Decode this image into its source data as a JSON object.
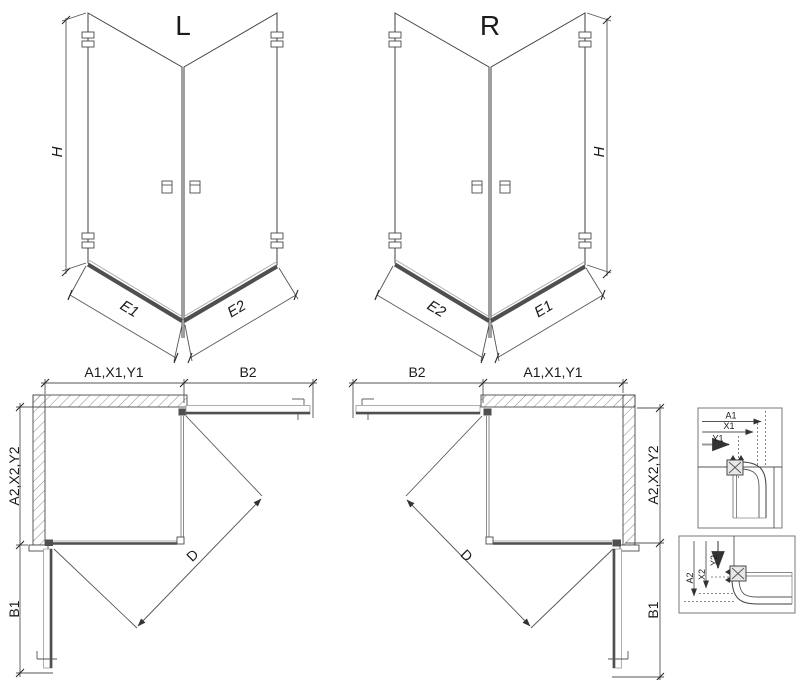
{
  "colors": {
    "background": "#ffffff",
    "line": "#3f3f3f",
    "dim_line": "#555555",
    "glass_thick": "#4f4f4f",
    "hatch": "#8a8a8a",
    "text": "#1b1b1b"
  },
  "iso_views": [
    {
      "title": "L",
      "height_dim": "H",
      "bottom_dims": [
        "E1",
        "E2"
      ]
    },
    {
      "title": "R",
      "height_dim": "H",
      "bottom_dims": [
        "E2",
        "E1"
      ]
    }
  ],
  "plan_views": [
    {
      "position": "left",
      "top_dims": [
        "A1,X1,Y1",
        "B2"
      ],
      "side_dim": "A2,X2,Y2",
      "bottom_dim": "B1",
      "diagonal_dim": "D"
    },
    {
      "position": "right",
      "top_dims": [
        "B2",
        "A1,X1,Y1"
      ],
      "side_dim": "A2,X2,Y2",
      "bottom_dim": "B1",
      "diagonal_dim": "D"
    }
  ],
  "detail_views": [
    {
      "orientation": "horizontal",
      "dim_labels": [
        "A1",
        "X1",
        "Y1"
      ]
    },
    {
      "orientation": "vertical",
      "dim_labels": [
        "A2",
        "X2",
        "Y2"
      ]
    }
  ]
}
